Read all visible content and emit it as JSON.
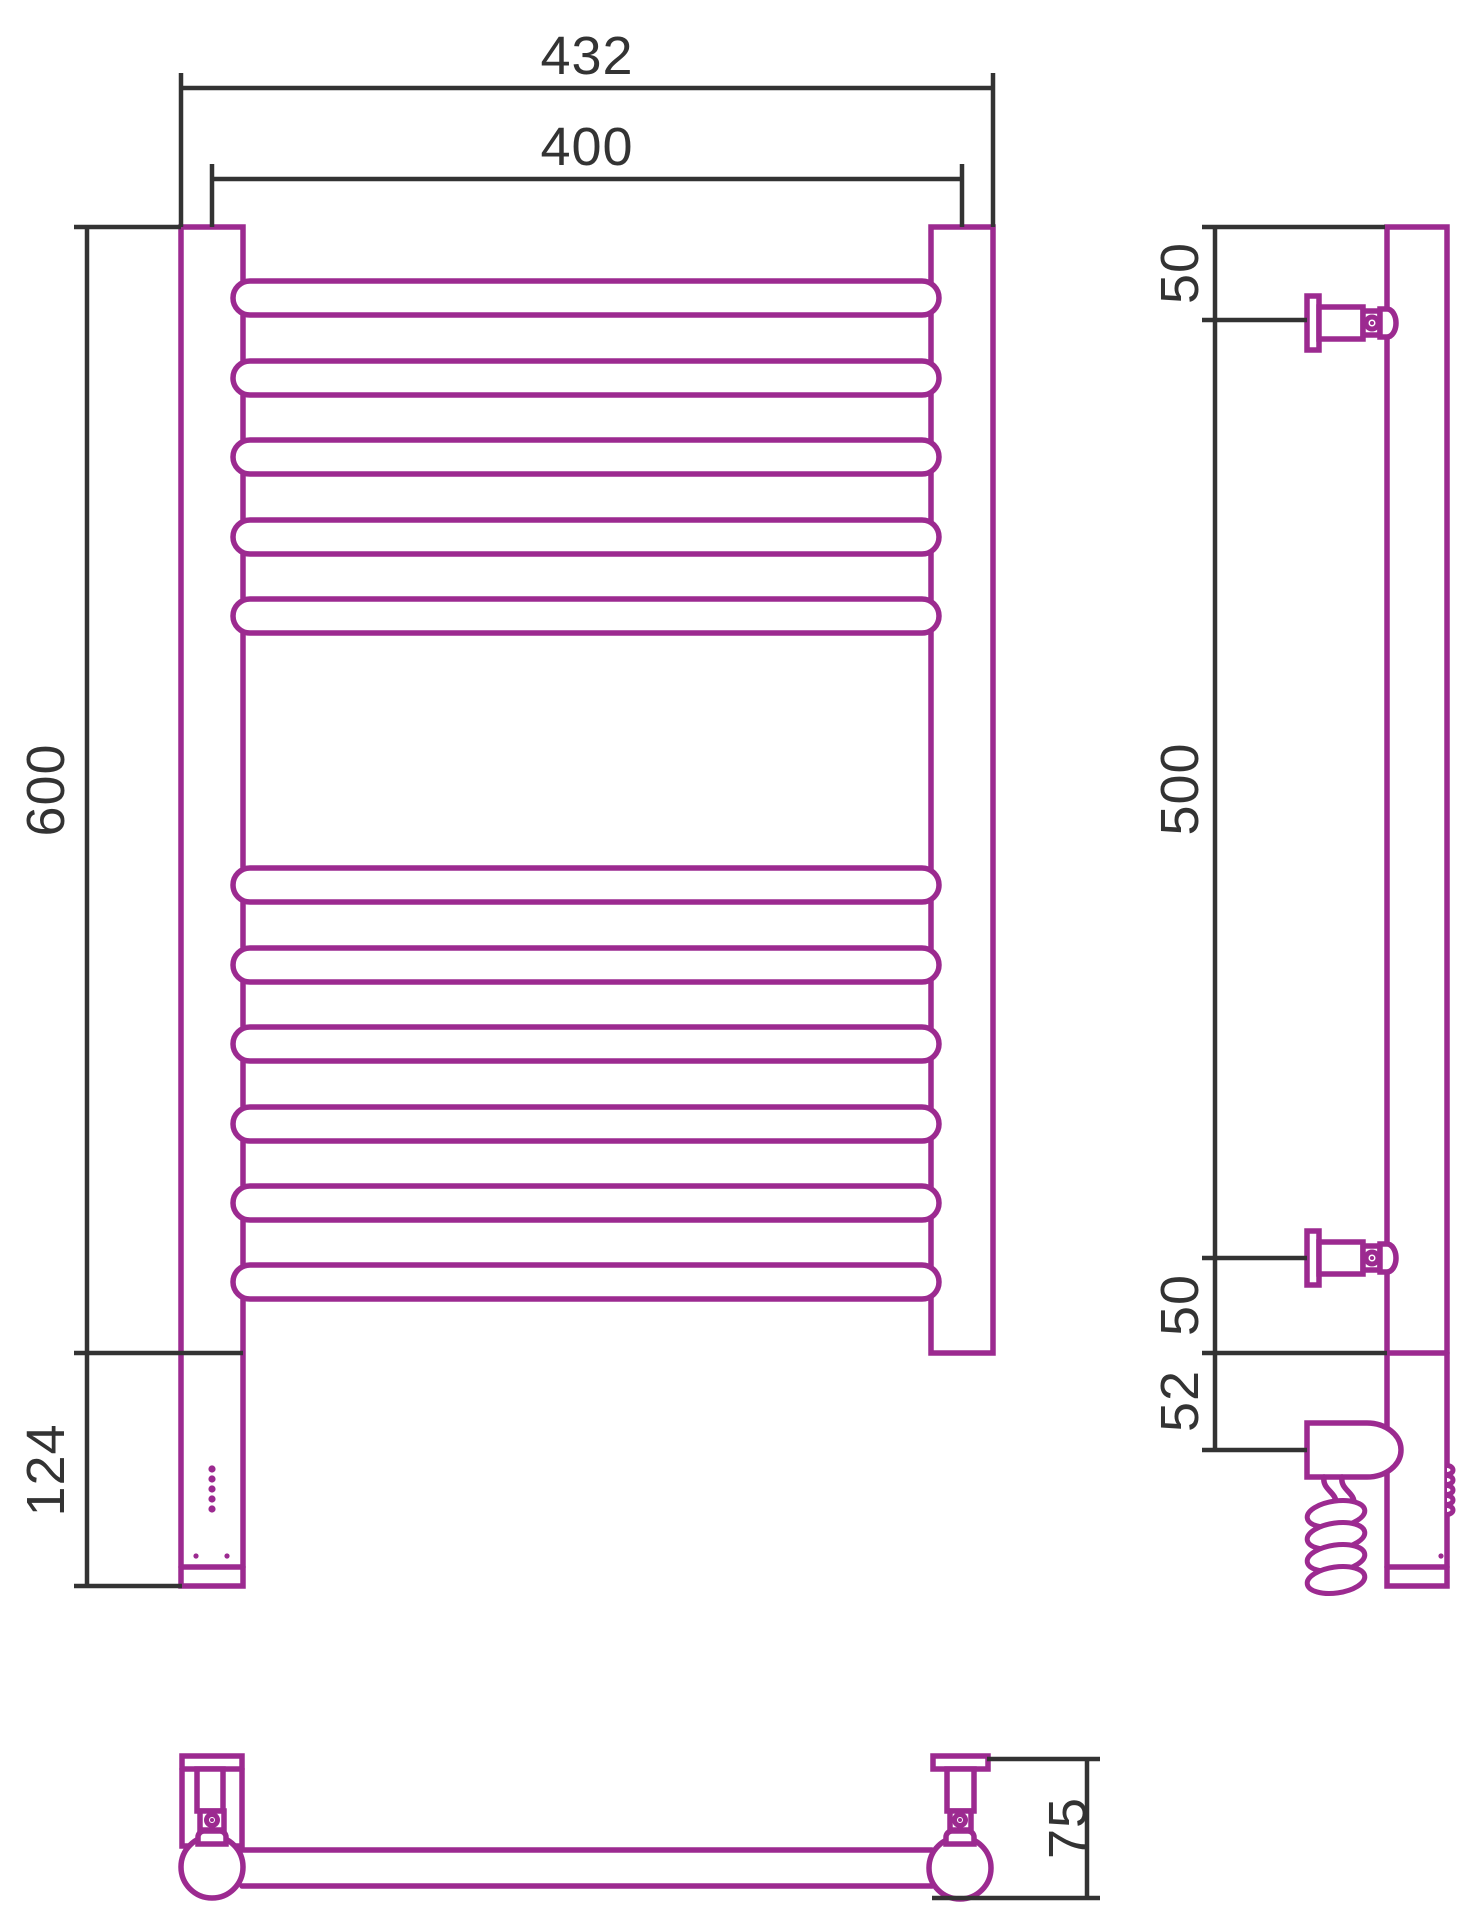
{
  "drawing": {
    "colors": {
      "product": "#9c2a90",
      "dimension": "#333333",
      "background": "#ffffff"
    },
    "front_view": {
      "overall_width": "432",
      "rail_center_width": "400",
      "height": "600",
      "heater_section_height": "124"
    },
    "side_view": {
      "top_bracket_offset": "50",
      "bracket_span": "500",
      "bottom_bracket_offset": "50",
      "cable_entry_offset": "52"
    },
    "top_view": {
      "wall_depth": "75"
    }
  }
}
